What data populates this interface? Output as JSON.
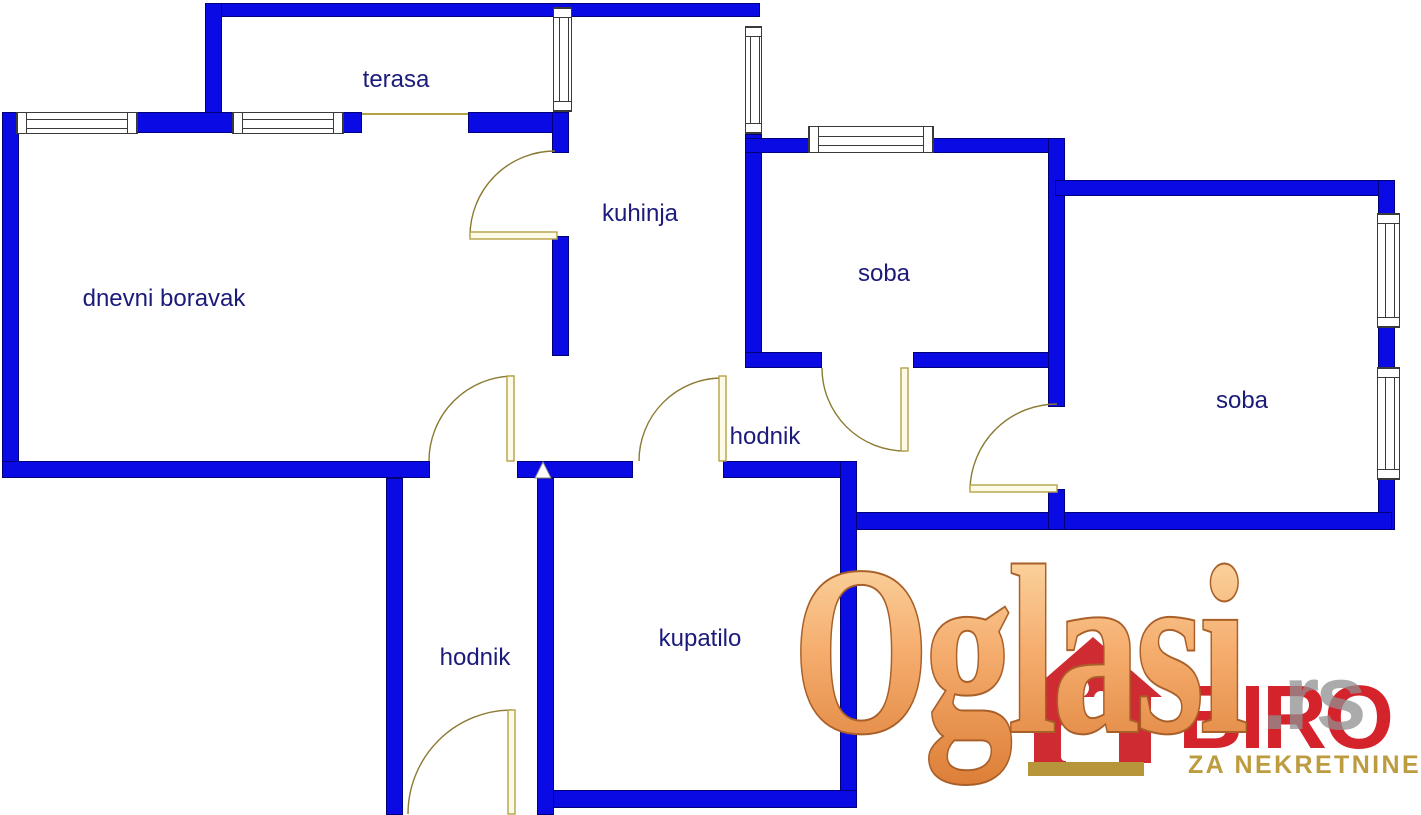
{
  "floor_plan": {
    "labels": {
      "terasa": "terasa",
      "kuhinja": "kuhinja",
      "dnevni_boravak": "dnevni boravak",
      "soba_1": "soba",
      "soba_2": "soba",
      "hodnik_1": "hodnik",
      "hodnik_2": "hodnik",
      "kupatilo": "kupatilo"
    },
    "colors": {
      "wall": "#0a0ae4",
      "wall_outline": "#000078",
      "door_stroke": "#8b7b33",
      "door_leaf_fill": "#fdfae6",
      "door_leaf_stroke": "#b3a146",
      "window_frame": "#3a3a3a",
      "label_text": "#1b1b7c",
      "plan_background": "#ffffff"
    }
  },
  "watermark": {
    "brand": "Oglasi",
    "brand_suffix": ".rs",
    "agency_name": "BIRO",
    "agency_tagline": "ZA NEKRETNINE",
    "colors": {
      "brand_fill_top": "#fde2b2",
      "brand_fill_mid": "#f5ad6e",
      "brand_fill_bottom": "#dd7f38",
      "brand_outline": "#a95f28",
      "suffix_gray": "#909090",
      "logo_red": "#d5232c",
      "logo_gold": "#bd9b3f",
      "house_red": "#cf2b33",
      "base_gold": "#b6953b"
    }
  }
}
